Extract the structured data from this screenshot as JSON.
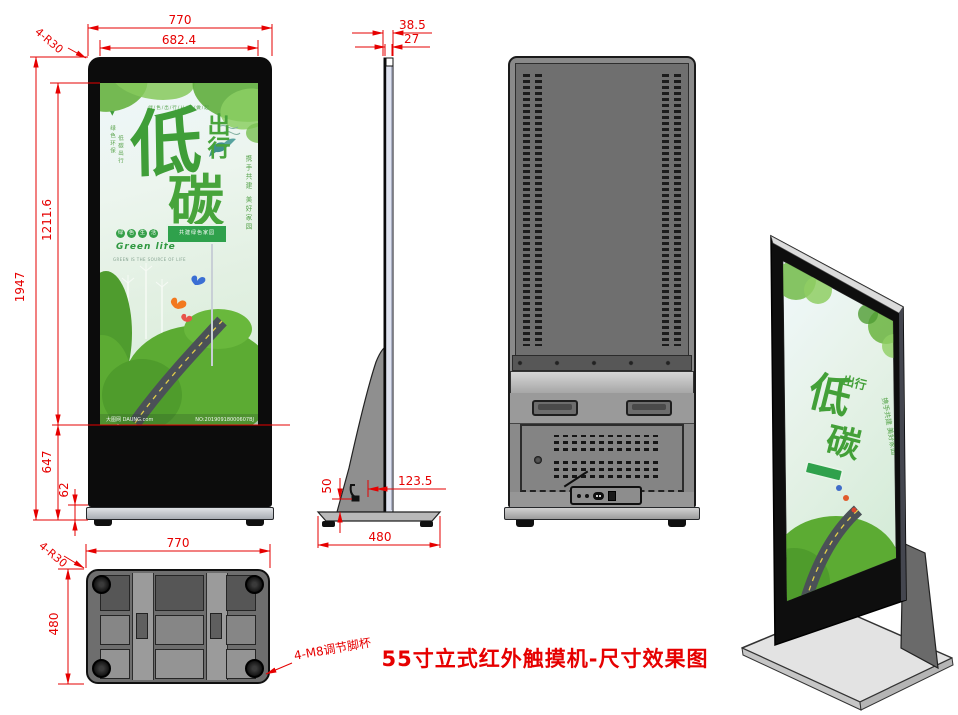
{
  "title": "55寸立式红外触摸机-尺寸效果图",
  "dims": {
    "front": {
      "width": "770",
      "screen_width": "682.4",
      "corner_radius": "4-R30",
      "total_height": "1947",
      "screen_height": "1211.6",
      "lower_height": "647",
      "base_height": "62"
    },
    "side": {
      "total_depth": "38.5",
      "panel_depth": "27",
      "stand_offset": "123.5",
      "stand_height": "50",
      "base_depth": "480"
    },
    "bottom": {
      "width": "770",
      "depth": "480",
      "corner_radius": "4-R30",
      "feet_note": "4-M8调节脚杯"
    }
  },
  "poster": {
    "top_slogan": "绿/色/出/行/从/我/做/起",
    "marker": "▼",
    "left_col1": "绿色环保",
    "left_col2": "低碳出行",
    "headline_main": "低",
    "headline_side": "出行",
    "headline_bottom": "碳",
    "right_vertical": "携手共建 美好家园",
    "badges": [
      "绿",
      "色",
      "生",
      "活"
    ],
    "green_life": "Green life",
    "tagline": "GREEN IS THE SOURCE OF LIFE",
    "sign_text": "共建绿色家园",
    "watermark_left": "大图网 DAUNG.com",
    "watermark_right": "NO:20190918000607BJ"
  },
  "colors": {
    "dimension_red": "#e60000",
    "body_black": "#0c0c0c",
    "back_gray": "#8a8a8a",
    "poster_green": "#3f9e38"
  }
}
